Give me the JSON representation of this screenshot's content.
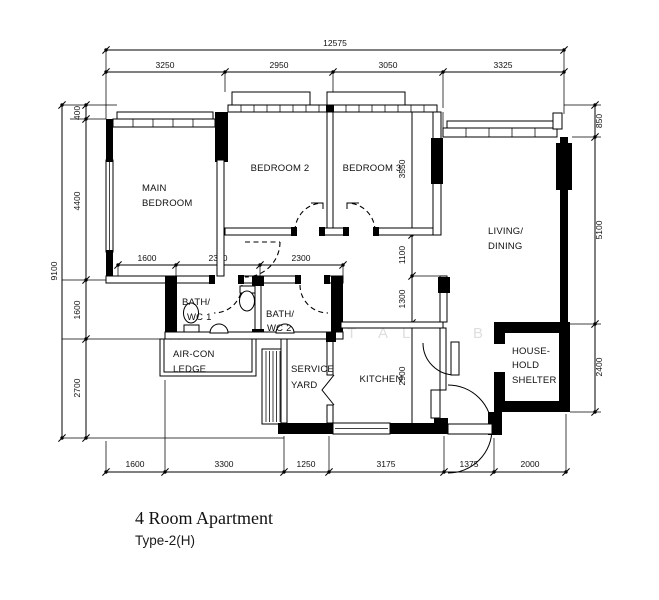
{
  "drawing": {
    "title": "4 Room Apartment",
    "subtitle": "Type-2(H)"
  },
  "rooms": {
    "main_bedroom": [
      "MAIN",
      "BEDROOM"
    ],
    "bedroom_2": [
      "BEDROOM 2"
    ],
    "bedroom_3": [
      "BEDROOM 3"
    ],
    "living_dining": [
      "LIVING/",
      "DINING"
    ],
    "bath_wc_1": [
      "BATH/",
      "WC 1"
    ],
    "bath_wc_2": [
      "BATH/",
      "WC 2"
    ],
    "aircon_ledge": [
      "AIR-CON",
      "LEDGE"
    ],
    "service_yard": [
      "SERVICE",
      "YARD"
    ],
    "kitchen": [
      "KITCHEN"
    ],
    "household_shelter": [
      "HOUSE-",
      "HOLD",
      "SHELTER"
    ]
  },
  "dims": {
    "top_overall": "12575",
    "top_segments": [
      "3250",
      "2950",
      "3050",
      "3325"
    ],
    "left_overall": "9100",
    "left_segments": [
      "400",
      "4400",
      "1600",
      "2700"
    ],
    "right_segments": [
      "850",
      "5100",
      "2400"
    ],
    "mid_segments": [
      "3550",
      "1100",
      "1300",
      "2900"
    ],
    "inner_segments": [
      "1600",
      "2300",
      "2300"
    ],
    "bottom_segments": [
      "1600",
      "3300",
      "1250",
      "3175",
      "1375",
      "2000"
    ]
  },
  "watermark": [
    "A",
    "T",
    "A",
    "L",
    "I",
    "B"
  ]
}
